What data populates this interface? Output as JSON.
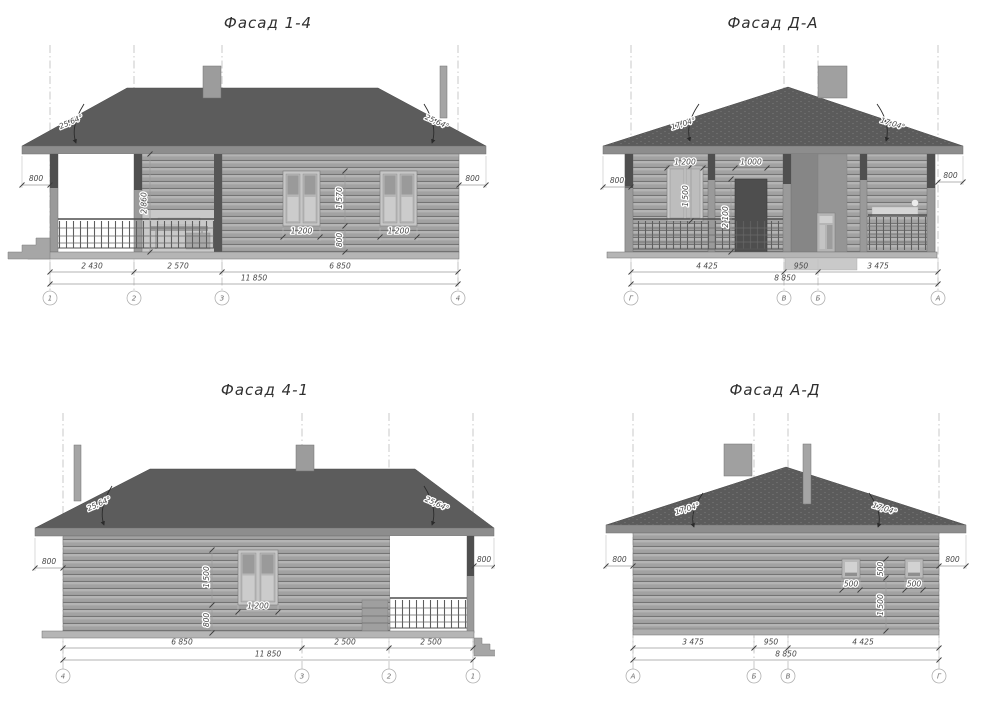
{
  "sheet": {
    "drawing_type": "house facade elevations",
    "colors": {
      "roof": "#5c5c5c",
      "fascia": "#8d8d8d",
      "wall_log": "#a2a2a2",
      "window": "#c6c6c6",
      "door": "#4e4e4e",
      "floor": "#b5b5b5",
      "dim_text": "#474747",
      "axis_line": "#bcbcbc"
    }
  },
  "facades": {
    "f14": {
      "title": "Фасад 1-4",
      "roof_angle": "25,64°",
      "overhang": "800",
      "porch_height": "2 860",
      "window_width": "1 200",
      "window_height": "1 570",
      "sill_height": "800",
      "spans": [
        "2 430",
        "2 570",
        "6 850"
      ],
      "total": "11 850",
      "axes": [
        "1",
        "2",
        "3",
        "4"
      ]
    },
    "fda": {
      "title": "Фасад Д-А",
      "roof_angle": "17,04°",
      "overhang": "800",
      "window_width": "1 200",
      "door_width": "1 000",
      "window_height": "1 500",
      "door_height": "2 100",
      "spans": [
        "4 425",
        "950",
        "3 475"
      ],
      "total": "8 850",
      "axes": [
        "Г",
        "В",
        "Б",
        "А"
      ]
    },
    "f41": {
      "title": "Фасад 4-1",
      "roof_angle": "25,64°",
      "overhang": "800",
      "window_width": "1 200",
      "window_height": "1 500",
      "sill_height": "800",
      "spans": [
        "6 850",
        "2 500",
        "2 500"
      ],
      "total": "11 850",
      "axes": [
        "4",
        "3",
        "2",
        "1"
      ]
    },
    "fad": {
      "title": "Фасад А-Д",
      "roof_angle": "17,04°",
      "overhang": "800",
      "window_width": "500",
      "window_height": "500",
      "sill_height": "1 500",
      "spans": [
        "3 475",
        "950",
        "4 425"
      ],
      "total": "8 850",
      "axes": [
        "А",
        "Б",
        "В",
        "Г"
      ]
    }
  }
}
